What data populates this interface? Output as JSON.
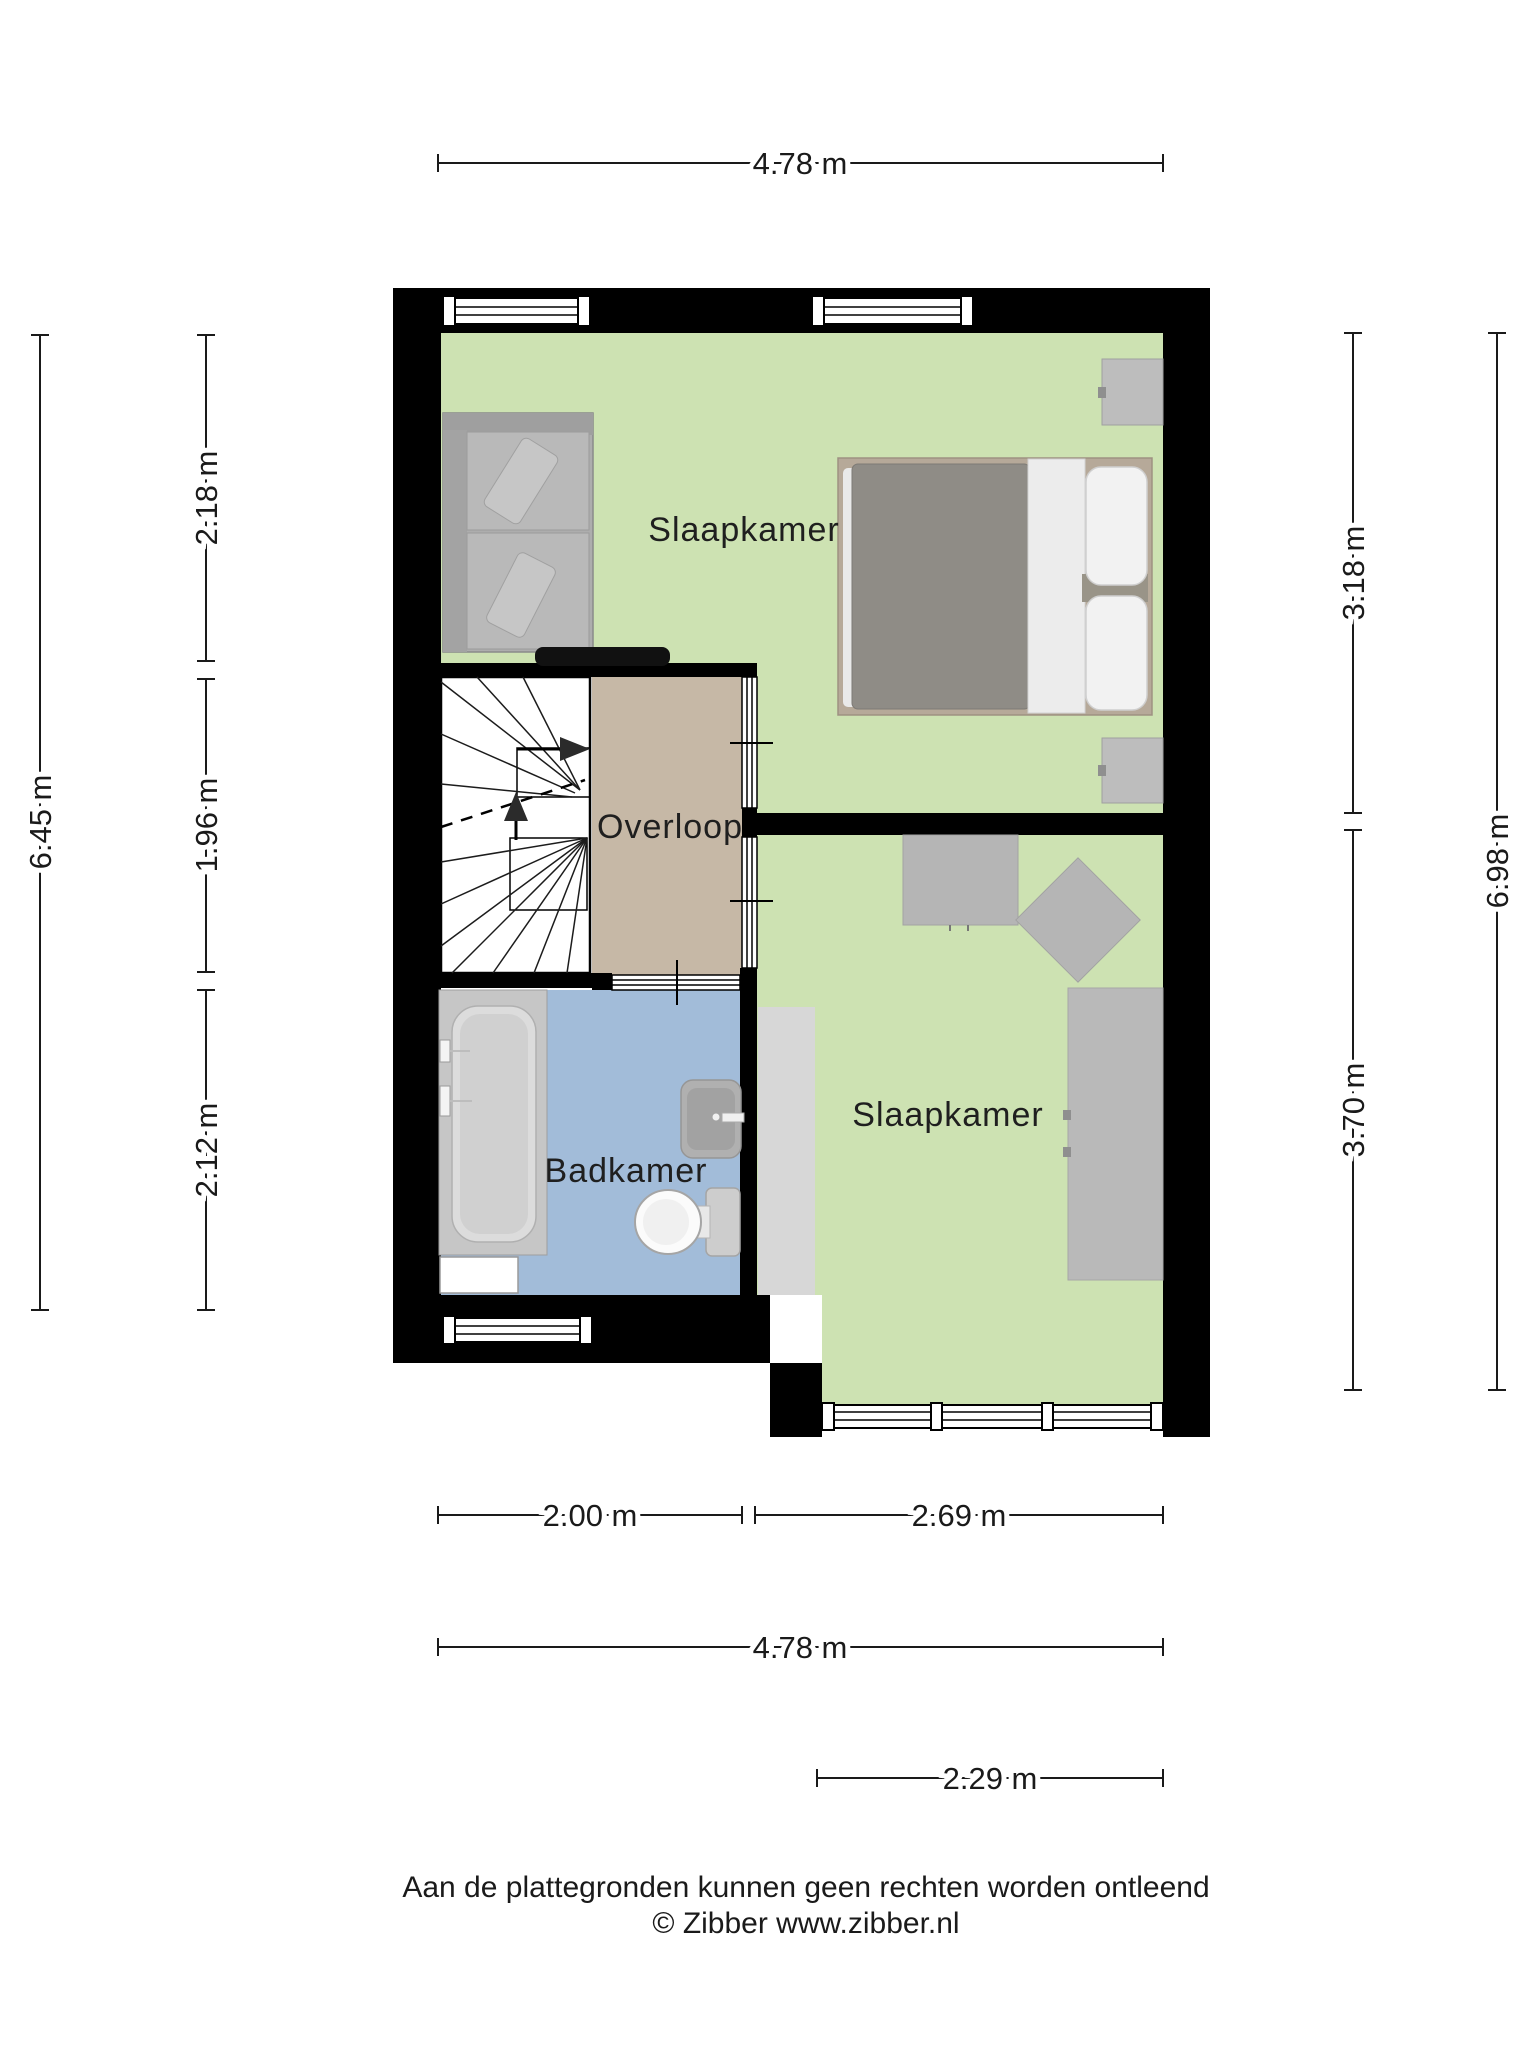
{
  "floorplan": {
    "rooms": [
      {
        "id": "slaapkamer-1",
        "label": "Slaapkamer"
      },
      {
        "id": "overloop",
        "label": "Overloop"
      },
      {
        "id": "badkamer",
        "label": "Badkamer"
      },
      {
        "id": "slaapkamer-2",
        "label": "Slaapkamer"
      }
    ],
    "dimensions": {
      "top_width": "4.78 m",
      "left_segments": [
        "2.18 m",
        "1.96 m",
        "2.12 m"
      ],
      "left_total": "6.45 m",
      "right_segments": [
        "3.18 m",
        "3.70 m"
      ],
      "right_total": "6.98 m",
      "bottom_segments": [
        "2.00 m",
        "2.69 m"
      ],
      "bottom_total": "4.78 m",
      "bottom_window_width": "2.29 m"
    },
    "colors": {
      "wall": "#000000",
      "floor_green": "#cde2b2",
      "floor_tan": "#c6b8a6",
      "floor_blue": "#a2bcd9",
      "stairs_white": "#ffffff",
      "furniture_gray": "#b5b5b5",
      "wardrobe_light": "#d7d7d7",
      "wardrobe_dark": "#b9b9b9",
      "sofa_gray": "#adadad",
      "bed_frame": "#b6a999",
      "bed_duvet": "#8f8c86",
      "linen_white": "#f2f2f2",
      "table_black": "#111111"
    }
  },
  "footer": {
    "disclaimer": "Aan de plattegronden kunnen geen rechten worden ontleend",
    "credit": "© Zibber www.zibber.nl"
  }
}
